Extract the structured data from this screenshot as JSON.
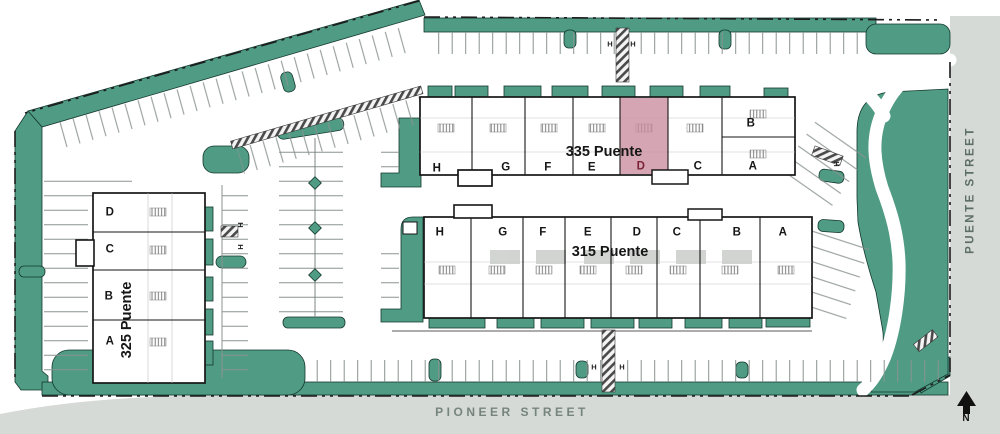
{
  "streets": {
    "bottom_label": "PIONEER STREET",
    "right_label": "PUENTE STREET"
  },
  "compass": {
    "north_label": "N"
  },
  "buildings": [
    {
      "name": "335 Puente",
      "units": [
        "H",
        "G",
        "F",
        "E",
        "D",
        "C",
        "B",
        "A"
      ],
      "highlighted_unit": "D"
    },
    {
      "name": "315 Puente",
      "units": [
        "H",
        "G",
        "F",
        "E",
        "D",
        "C",
        "B",
        "A"
      ],
      "highlighted_unit": null
    },
    {
      "name": "325 Puente",
      "units": [
        "D",
        "C",
        "B",
        "A"
      ],
      "highlighted_unit": null
    }
  ],
  "markers": {
    "handicap_label": "H"
  },
  "colors": {
    "landscape": "#4f9b84",
    "unit_highlight": "#ca8c9e",
    "highlight_text": "#7b2438",
    "street_fill": "#d6dad6",
    "street_text": "#76847f",
    "plan_background": "#ffffff",
    "line": "#161616"
  }
}
